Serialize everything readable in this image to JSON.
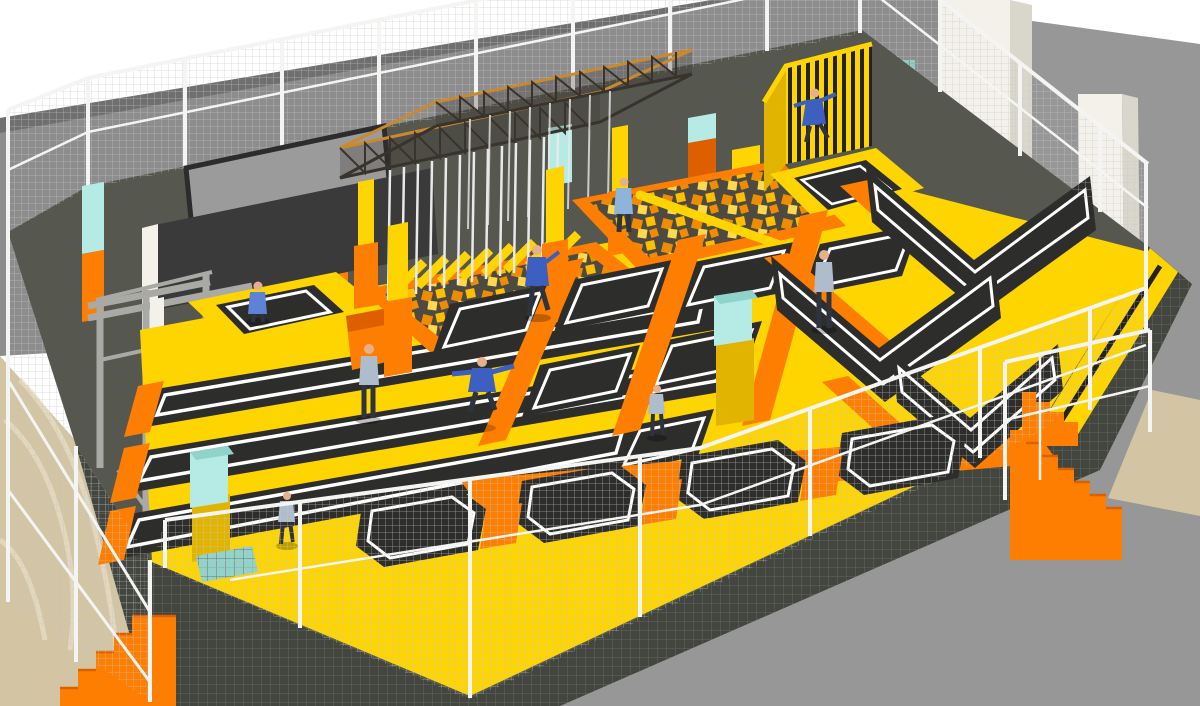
{
  "scene": {
    "title": "Indoor Trampoline Park 3D Render",
    "description": "Perspective 3D rendering of an indoor trampoline park hall with orange and yellow padded courts, black trampoline beds with white piping, foam cube pits, a ninja truss rig with hanging poles, a striped climbing wall, angled wall trampolines, slam-dunk basketball lanes, mesh safety fencing, concrete columns, marble flooring and orange access stairs.",
    "people_count": 9,
    "areas": [
      {
        "id": "square-trampoline-grid",
        "label": "Square trampoline grid"
      },
      {
        "id": "runway-lanes",
        "label": "Tumble runway lanes"
      },
      {
        "id": "ninja-truss-rig",
        "label": "Ninja truss rig with hanging poles"
      },
      {
        "id": "truss-foam-pit",
        "label": "Foam pit under truss with yellow planks"
      },
      {
        "id": "main-foam-pit",
        "label": "Foam cube pit with balance beam"
      },
      {
        "id": "striped-wall",
        "label": "Black striped vertical wall"
      },
      {
        "id": "wall-trampolines",
        "label": "Angled wall trampolines"
      },
      {
        "id": "front-angled-beds",
        "label": "Front angled trampoline row"
      },
      {
        "id": "basketball-lanes",
        "label": "Slam dunk basketball hoops"
      },
      {
        "id": "reception-desk",
        "label": "Desk with display screen"
      },
      {
        "id": "safety-fence",
        "label": "White framed mesh safety fence"
      },
      {
        "id": "stairs-left",
        "label": "Orange stairs bottom-left"
      },
      {
        "id": "stairs-right",
        "label": "Orange stairs right"
      },
      {
        "id": "column-pads",
        "label": "Teal protective column pads"
      }
    ]
  },
  "colors": {
    "background": "#ffffff",
    "wall": "#8d8d8d",
    "wall_top": "#6f6f6f",
    "floor_outside": "#979797",
    "marble": "#d3c5a4",
    "marble_vein": "#e9e0c8",
    "platform": "#56584f",
    "platform_face": "#43463f",
    "fence_white": "#f4f4f2",
    "mesh": "#c6c6c6",
    "mesh_dark": "#666960",
    "yellow": "#fed500",
    "yellow_shade": "#e0b400",
    "orange": "#fd7e00",
    "orange_shade": "#dd5f00",
    "bed": "#2d2d2b",
    "bed_dark": "#232321",
    "piping": "#ffffff",
    "teal": "#b5ebe4",
    "teal_shade": "#8fd3cb",
    "column_white": "#f3f1ea",
    "column_white_shade": "#d9d6cb",
    "steel": "#a9aaa6",
    "truss_dark": "#38332c",
    "truss_orange": "#c98a2f",
    "pole_white": "#e9e9e9",
    "desk": "#3a3a3a",
    "screen": "#9b9b9b",
    "foam_orange": "#f08c00",
    "foam_amber": "#ffbf00",
    "foam_dark": "#4d4a42",
    "foam_yellow": "#ffd84d",
    "skin": "#e5b08c",
    "jacket_blue": "#3d5fc0",
    "jacket_blue2": "#5d82d6",
    "shirt_light": "#8fb4dc",
    "pants_dark": "#2e3340",
    "hoodie_gray": "#aebccb",
    "shadow": "#000000"
  }
}
